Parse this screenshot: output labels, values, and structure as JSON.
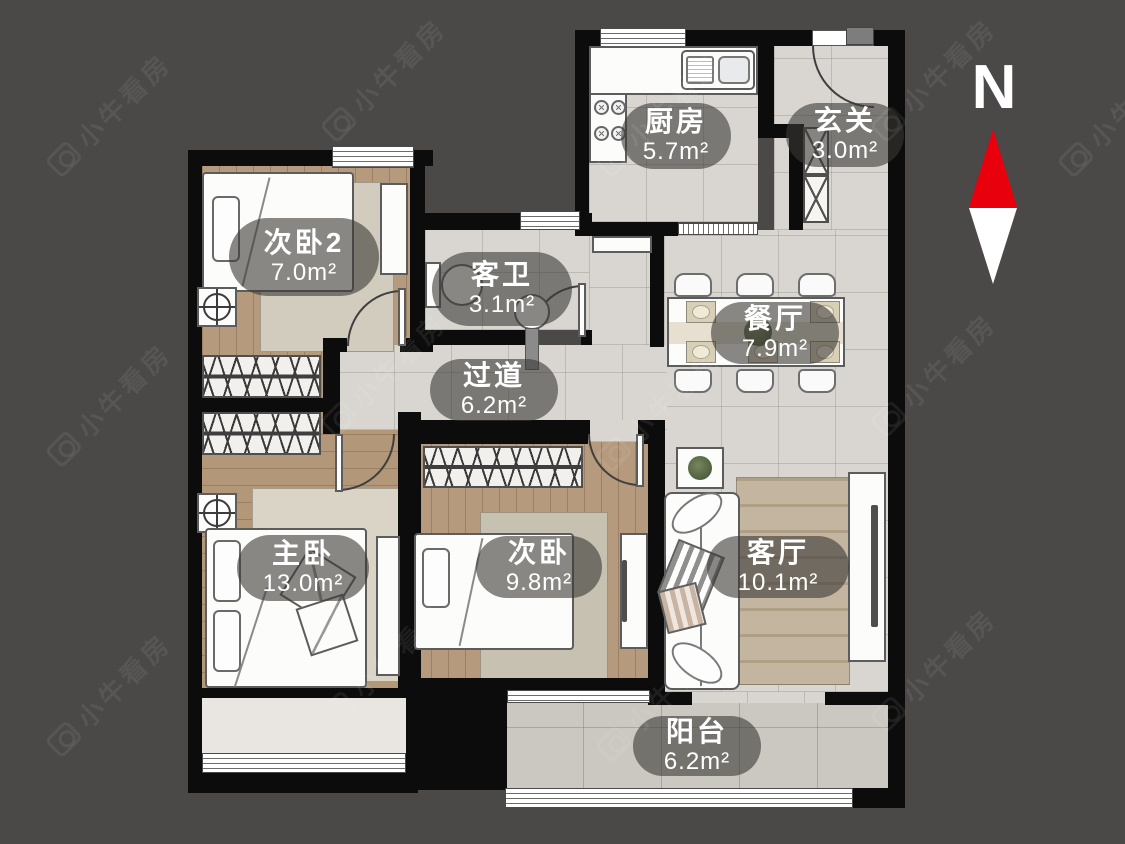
{
  "watermark": {
    "text": "小牛看房"
  },
  "compass": {
    "north_label": "N",
    "needle_north_color": "#e8000d",
    "needle_south_color": "#ffffff"
  },
  "rooms": {
    "bedroom2": {
      "name": "次卧2",
      "area": "7.0m²"
    },
    "bathroom": {
      "name": "客卫",
      "area": "3.1m²"
    },
    "kitchen": {
      "name": "厨房",
      "area": "5.7m²"
    },
    "entry": {
      "name": "玄关",
      "area": "3.0m²"
    },
    "dining": {
      "name": "餐厅",
      "area": "7.9m²"
    },
    "hallway": {
      "name": "过道",
      "area": "6.2m²"
    },
    "master_bedroom": {
      "name": "主卧",
      "area": "13.0m²"
    },
    "bedroom": {
      "name": "次卧",
      "area": "9.8m²"
    },
    "living": {
      "name": "客厅",
      "area": "10.1m²"
    },
    "balcony": {
      "name": "阳台",
      "area": "6.2m²"
    }
  },
  "colors": {
    "background": "#4b4848",
    "wall": "#0c0c0c",
    "wood_floor": "#b59a7d",
    "tile_floor": "#d9d6d1",
    "label_pill": "rgba(58,56,54,0.60)",
    "compass_red": "#e8000d"
  }
}
